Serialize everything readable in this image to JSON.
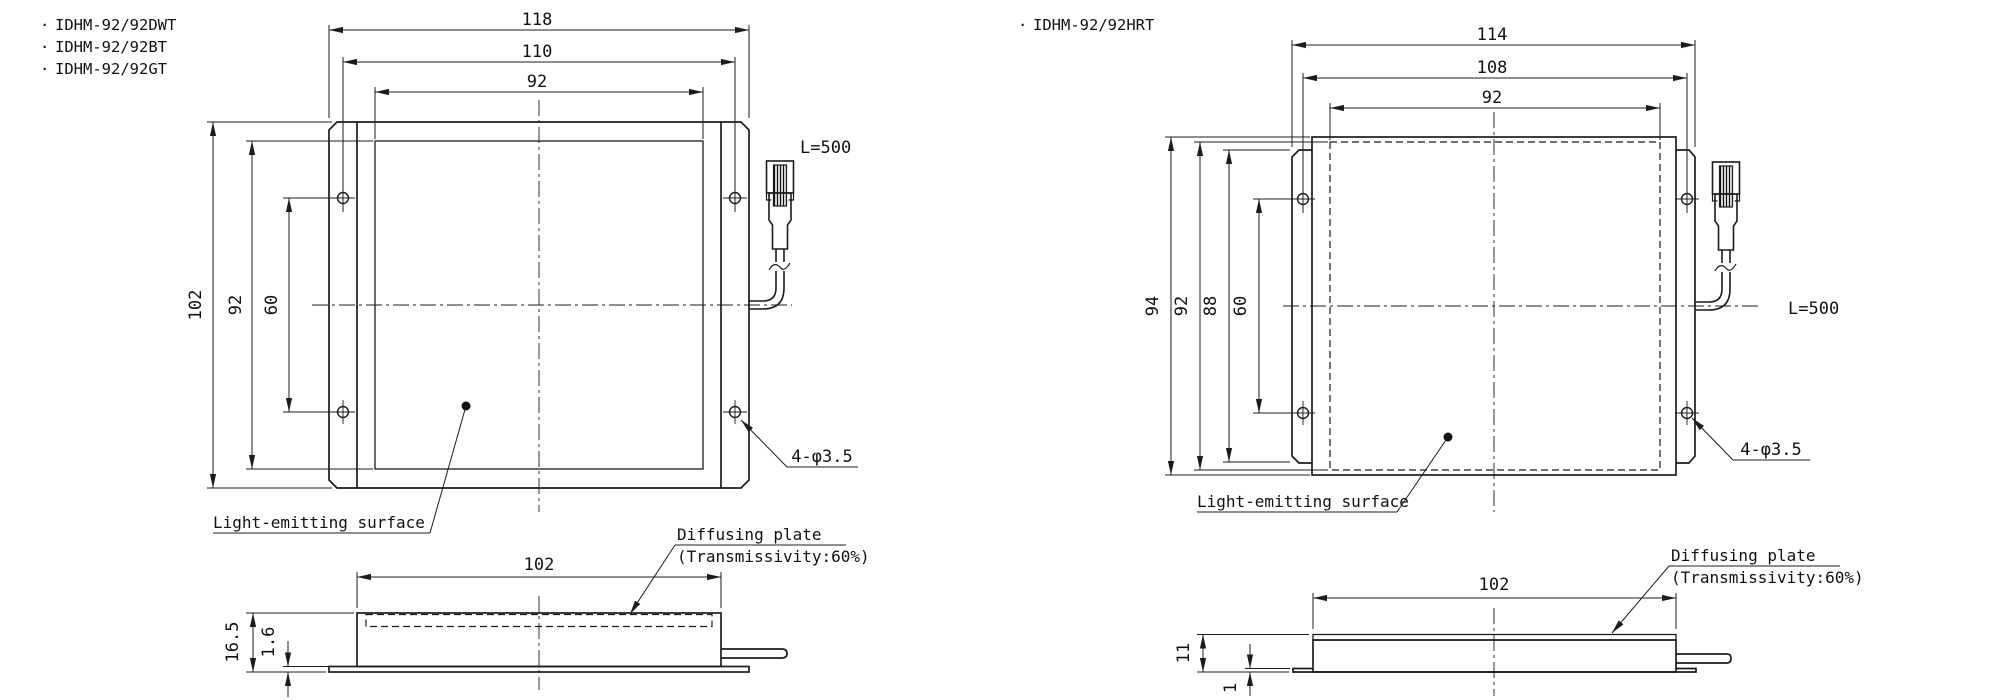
{
  "colors": {
    "background": "#ffffff",
    "line": "#1c1c1c"
  },
  "left_drawing": {
    "bullet": "·",
    "models": [
      "IDHM-92/92DWT",
      "IDHM-92/92BT",
      "IDHM-92/92GT"
    ],
    "front": {
      "width_outer": "118",
      "width_holes": "110",
      "width_window": "92",
      "height_outer": "102",
      "height_window": "92",
      "height_holes": "60",
      "cable_length": "L=500",
      "hole_callout": "4-φ3.5",
      "surface_label": "Light-emitting surface"
    },
    "side": {
      "width": "102",
      "height": "16.5",
      "flange": "1.6",
      "plate_label": "Diffusing plate",
      "plate_note": "(Transmissivity:60%)"
    }
  },
  "right_drawing": {
    "bullet": "·",
    "models": [
      "IDHM-92/92HRT"
    ],
    "front": {
      "width_outer": "114",
      "width_holes": "108",
      "width_window": "92",
      "height_outer": "94",
      "height_window": "92",
      "height_bracket": "88",
      "height_holes": "60",
      "cable_length": "L=500",
      "hole_callout": "4-φ3.5",
      "surface_label": "Light-emitting surface"
    },
    "side": {
      "width": "102",
      "height": "11",
      "flange": "1",
      "plate_label": "Diffusing plate",
      "plate_note": "(Transmissivity:60%)"
    }
  }
}
